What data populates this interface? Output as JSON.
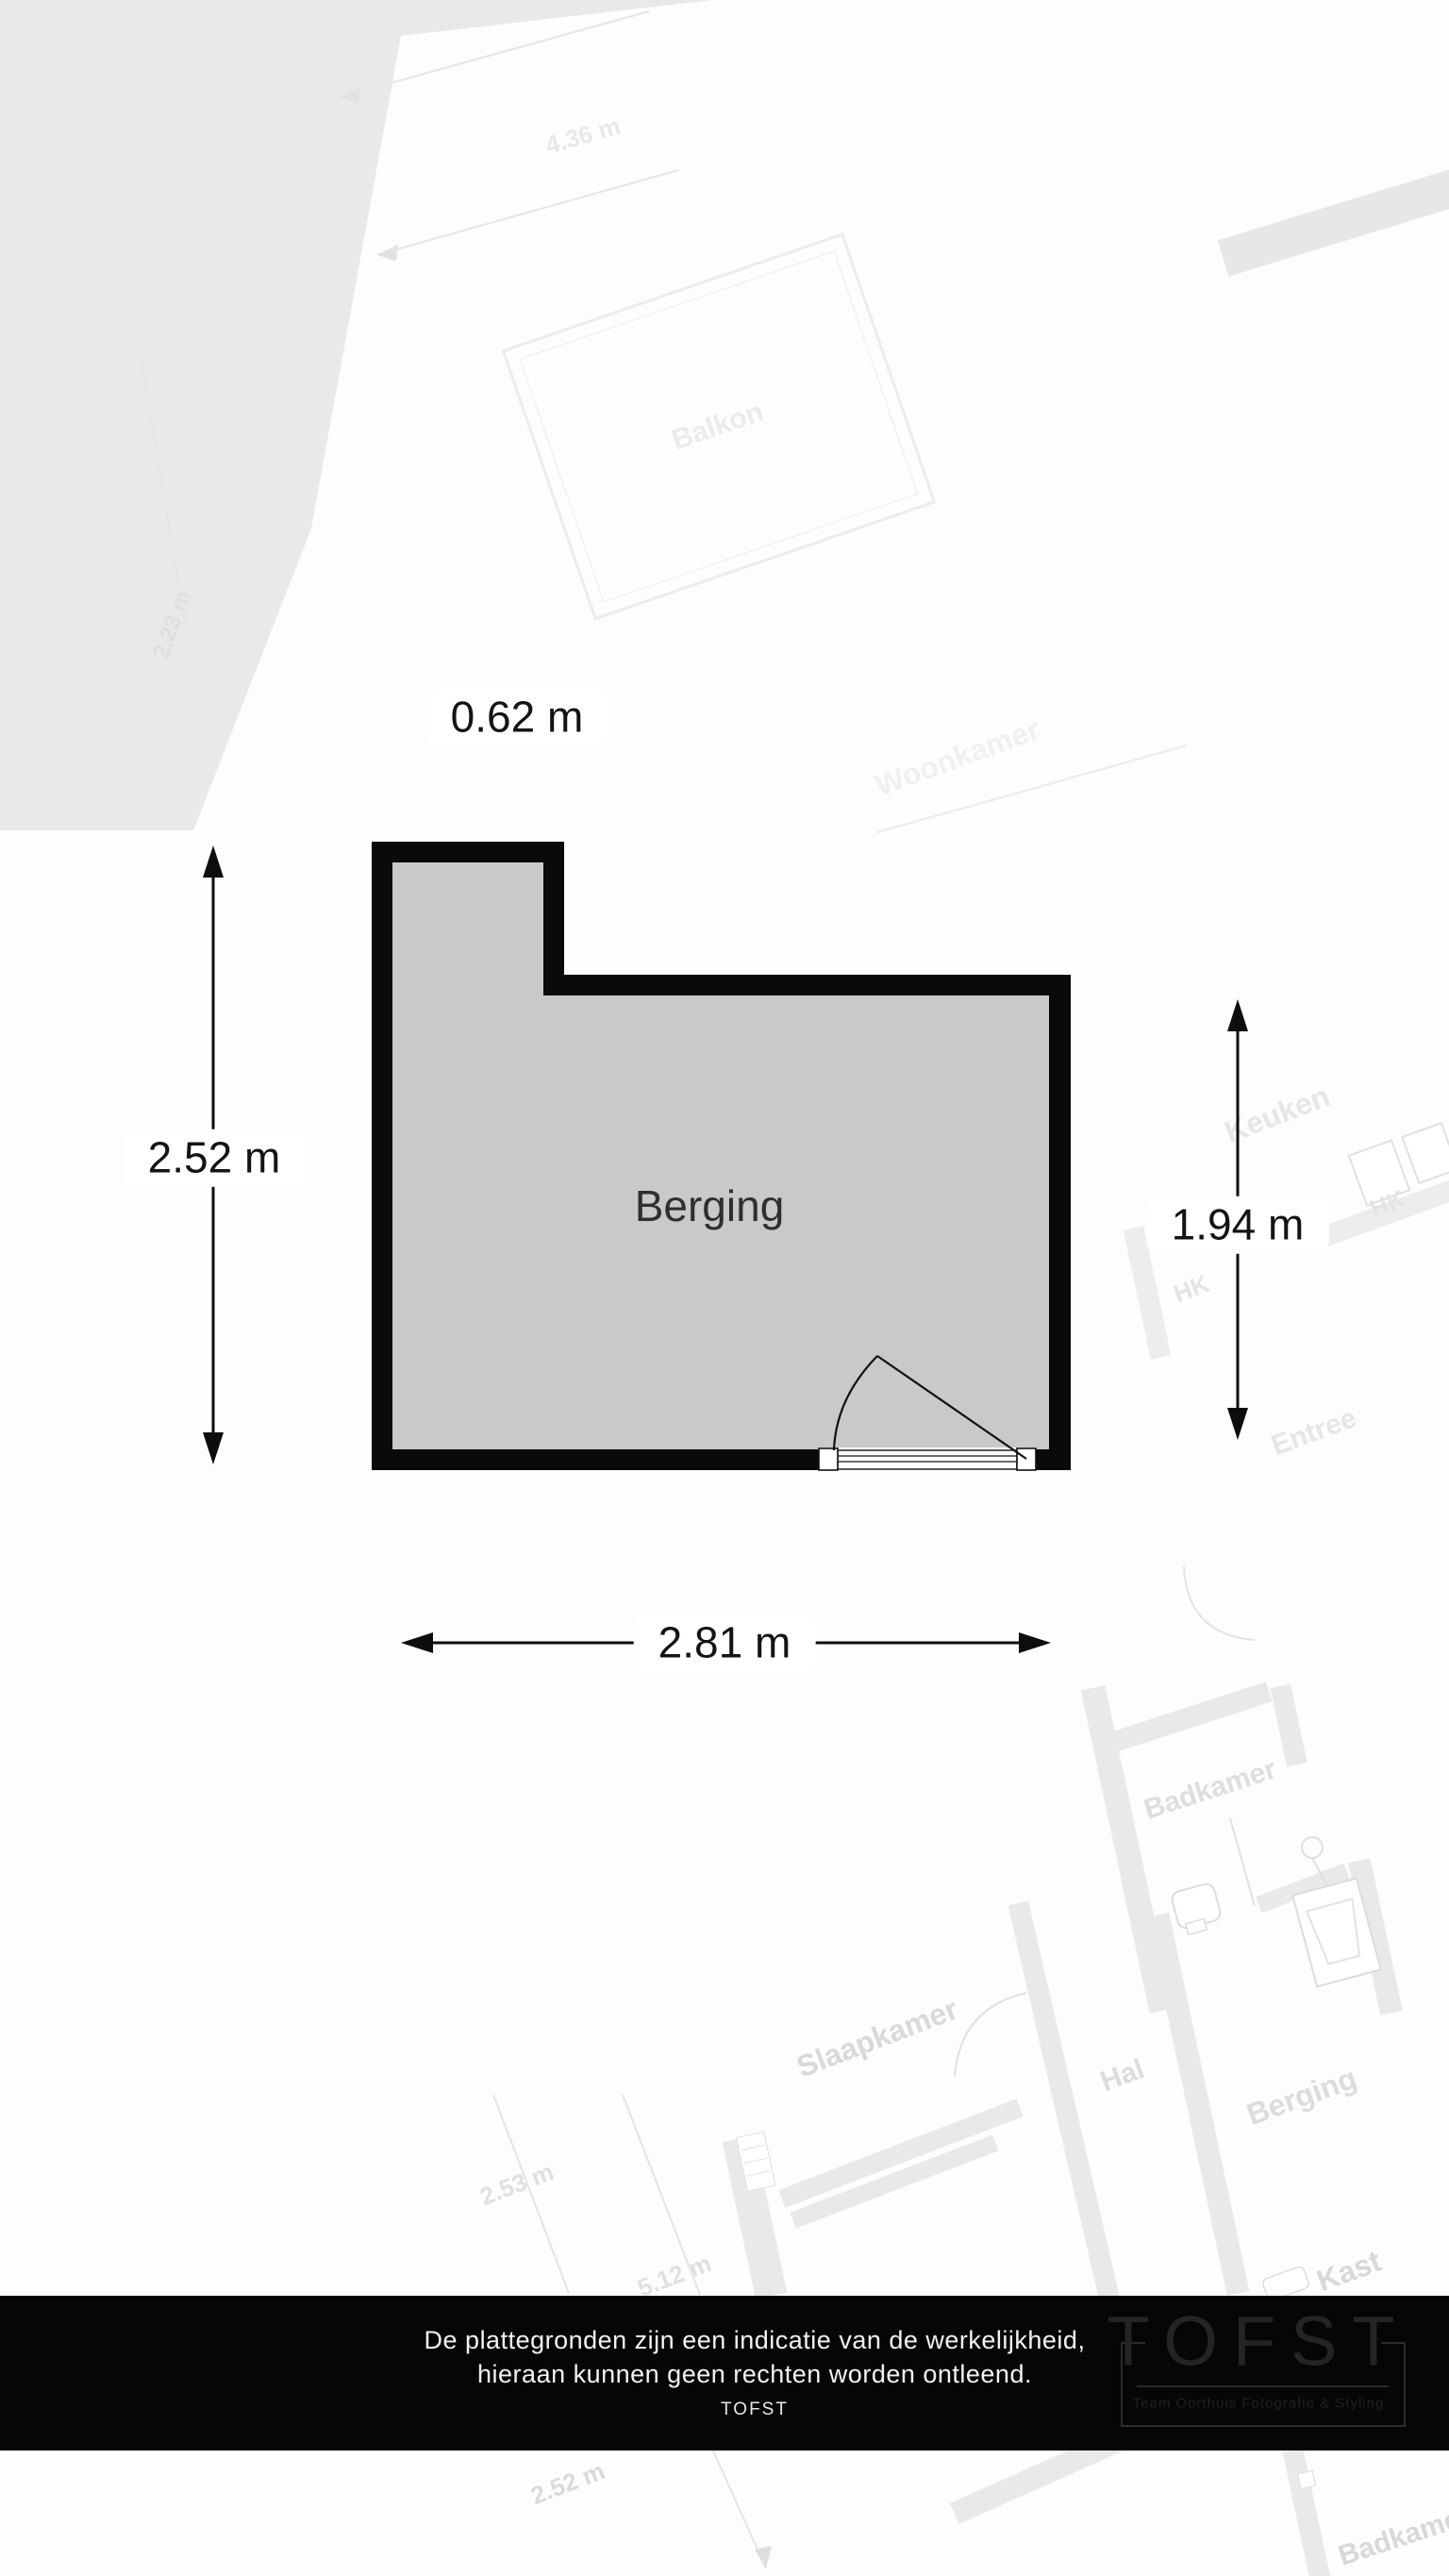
{
  "plan": {
    "room_label": "Berging",
    "dimensions": {
      "top": "0.62 m",
      "left": "2.52 m",
      "right": "1.94 m",
      "bottom": "2.81 m"
    },
    "colors": {
      "floor": "#c9c9c9",
      "wall": "#0a0a0a",
      "dimension_text": "#141414"
    }
  },
  "background": {
    "labels": [
      {
        "text": "Balkon"
      },
      {
        "text": "4.36 m"
      },
      {
        "text": "2.23 m"
      },
      {
        "text": "Woonkamer"
      },
      {
        "text": "Keuken"
      },
      {
        "text": "HK"
      },
      {
        "text": "HK"
      },
      {
        "text": "Entree"
      },
      {
        "text": "Badkamer"
      },
      {
        "text": "Slaapkamer"
      },
      {
        "text": "Hal"
      },
      {
        "text": "Berging"
      },
      {
        "text": "Kast"
      },
      {
        "text": "2.53 m"
      },
      {
        "text": "5.12 m"
      },
      {
        "text": "2.52 m"
      },
      {
        "text": "Badkamer"
      }
    ]
  },
  "footer": {
    "disclaimer_line1": "De plattegronden zijn een indicatie van de werkelijkheid,",
    "disclaimer_line2": "hieraan kunnen geen rechten worden ontleend.",
    "brand": "TOFST",
    "logo": {
      "name": "TOFST",
      "tagline": "Team Oorthuis Fotografie & Styling"
    },
    "bar_color": "#060606"
  }
}
